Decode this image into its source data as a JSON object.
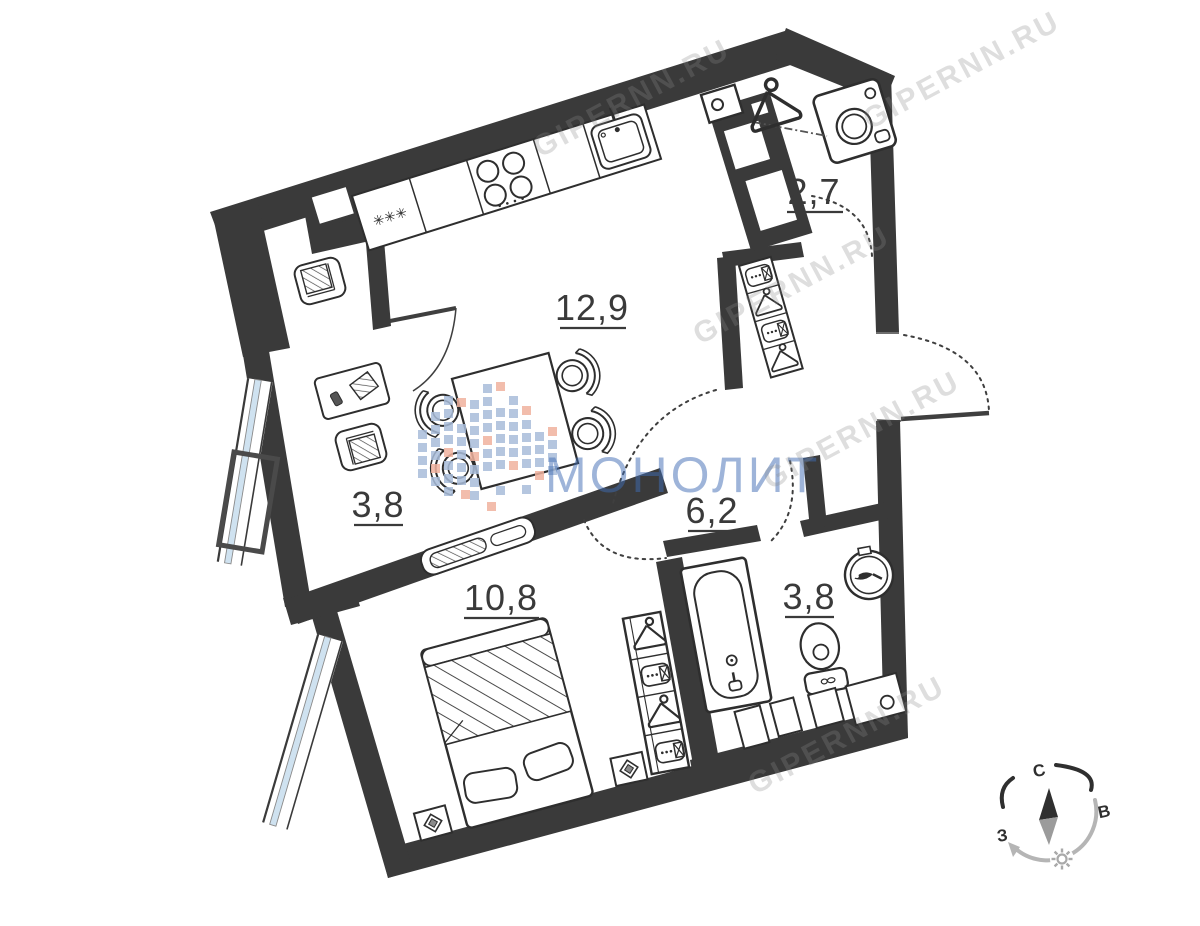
{
  "page": {
    "background": "#ffffff"
  },
  "floor_plan": {
    "room_labels": {
      "kitchen_living": "12,9",
      "laundry": "2,7",
      "study": "3,8",
      "hallway": "6,2",
      "bedroom": "10,8",
      "bathroom": "3,8"
    },
    "fridge_marks": "✳✳✳",
    "fixtures": [
      "fridge",
      "cooktop",
      "kitchen-sink",
      "dining-table",
      "chair",
      "armchair",
      "desk",
      "tv-stand",
      "double-bed",
      "pillow",
      "nightstand",
      "wardrobe",
      "hall-closet",
      "washing-machine",
      "clothes-hanger",
      "hanging-rod",
      "bathtub",
      "toilet",
      "washbasin",
      "duct-shaft",
      "window",
      "balcony-basket",
      "door-swing"
    ],
    "colors": {
      "wall": "#3a3a3a",
      "window_glass": "#cfe2f0",
      "line": "#2e2e2e",
      "label": "#3a3a3a"
    }
  },
  "watermark": {
    "brand": "МОНОЛИТ",
    "brand_color": "#3f6cb4",
    "site": "GIPERNN.RU",
    "logo_blue": "#a9bdda",
    "logo_salmon": "#f0b29e"
  },
  "compass": {
    "north": "С",
    "east": "В",
    "west": "З"
  }
}
